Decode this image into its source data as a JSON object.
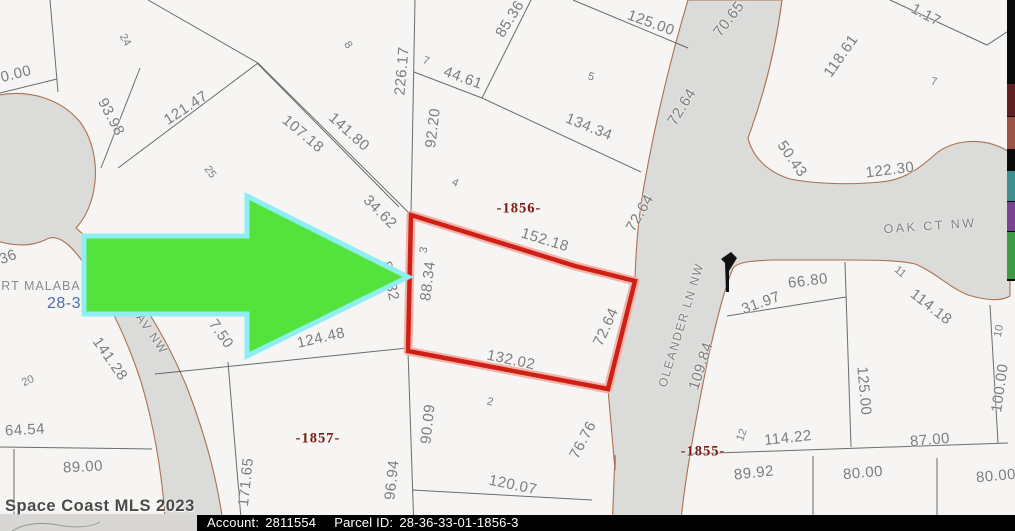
{
  "footer": {
    "watermark": "Space Coast MLS 2023",
    "account_label": "Account:",
    "account_value": "2811554",
    "parcel_label": "Parcel ID:",
    "parcel_value": "28-36-33-01-1856-3"
  },
  "colors": {
    "parcel_red": "#cf2016",
    "parcel_halo": "#f0b4ad",
    "arrow_green": "#54e33c",
    "arrow_cyan": "#8feef2",
    "road_gray": "#dbdbd9",
    "road_edge": "#ab7150",
    "line_gray": "#4a4a4a",
    "dim_gray": "#7d7d7d",
    "block_red": "#7a1a12",
    "plat_blue": "#4a6fae",
    "footer_bg": "#000000",
    "footer_text": "#ffffff"
  },
  "legend_strip": {
    "segments": [
      {
        "color": "#5e2020",
        "y": 84,
        "h": 32
      },
      {
        "color": "#9a5345",
        "y": 117,
        "h": 32
      },
      {
        "color": "#3d8e8c",
        "y": 171,
        "h": 30
      },
      {
        "color": "#7b4490",
        "y": 202,
        "h": 29
      },
      {
        "color": "#3e9a44",
        "y": 232,
        "h": 47
      }
    ]
  },
  "map": {
    "subject_parcel": {
      "block": "-1856-",
      "lot": "3",
      "dimensions": [
        "152.18",
        "72.64",
        "132.02",
        "88.34"
      ]
    },
    "labels": [
      {
        "t": "0.00",
        "x": 16,
        "y": 74,
        "r": -14,
        "c": "dim"
      },
      {
        "t": "93.98",
        "x": 111,
        "y": 117,
        "r": 62,
        "c": "dim"
      },
      {
        "t": "121.47",
        "x": 186,
        "y": 108,
        "r": -33,
        "c": "dim"
      },
      {
        "t": "107.18",
        "x": 303,
        "y": 134,
        "r": 40,
        "c": "dim"
      },
      {
        "t": "141.80",
        "x": 349,
        "y": 132,
        "r": 42,
        "c": "dim"
      },
      {
        "t": "226.17",
        "x": 402,
        "y": 71,
        "r": -85,
        "c": "dim"
      },
      {
        "t": "92.20",
        "x": 433,
        "y": 128,
        "r": -83,
        "c": "dim"
      },
      {
        "t": "44.61",
        "x": 463,
        "y": 78,
        "r": 20,
        "c": "dim"
      },
      {
        "t": "85.36",
        "x": 510,
        "y": 19,
        "r": -58,
        "c": "dim"
      },
      {
        "t": "125.00",
        "x": 651,
        "y": 23,
        "r": 20,
        "c": "dim"
      },
      {
        "t": "134.34",
        "x": 589,
        "y": 127,
        "r": 22,
        "c": "dim"
      },
      {
        "t": "70.65",
        "x": 729,
        "y": 19,
        "r": -52,
        "c": "dim"
      },
      {
        "t": "72.64",
        "x": 682,
        "y": 107,
        "r": -58,
        "c": "dim"
      },
      {
        "t": "118.61",
        "x": 841,
        "y": 56,
        "r": -55,
        "c": "dim"
      },
      {
        "t": "1.17",
        "x": 926,
        "y": 15,
        "r": 28,
        "c": "dim"
      },
      {
        "t": "122.30",
        "x": 890,
        "y": 170,
        "r": -7,
        "c": "dim"
      },
      {
        "t": "50.43",
        "x": 792,
        "y": 159,
        "r": 55,
        "c": "dim"
      },
      {
        "t": "72.64",
        "x": 640,
        "y": 213,
        "r": -60,
        "c": "dim"
      },
      {
        "t": "34.62",
        "x": 380,
        "y": 212,
        "r": 45,
        "c": "dim"
      },
      {
        "t": "152.18",
        "x": 545,
        "y": 240,
        "r": 17,
        "c": "dim"
      },
      {
        "t": "88.34",
        "x": 428,
        "y": 281,
        "r": -83,
        "c": "dim"
      },
      {
        "t": "88.32",
        "x": 390,
        "y": 281,
        "r": 78,
        "c": "dim"
      },
      {
        "t": "72.64",
        "x": 606,
        "y": 327,
        "r": -65,
        "c": "dim"
      },
      {
        "t": "132.02",
        "x": 511,
        "y": 360,
        "r": 12,
        "c": "dim"
      },
      {
        "t": "124.48",
        "x": 321,
        "y": 338,
        "r": -13,
        "c": "dim"
      },
      {
        "t": "7.50",
        "x": 221,
        "y": 334,
        "r": 55,
        "c": "dim"
      },
      {
        "t": "141.28",
        "x": 110,
        "y": 359,
        "r": 55,
        "c": "dim"
      },
      {
        "t": "66.80",
        "x": 808,
        "y": 281,
        "r": -7,
        "c": "dim"
      },
      {
        "t": "31.97",
        "x": 761,
        "y": 303,
        "r": -20,
        "c": "dim"
      },
      {
        "t": "114.18",
        "x": 931,
        "y": 307,
        "r": 38,
        "c": "dim"
      },
      {
        "t": "109.84",
        "x": 701,
        "y": 366,
        "r": -72,
        "c": "dim"
      },
      {
        "t": "125.00",
        "x": 864,
        "y": 391,
        "r": 85,
        "c": "dim"
      },
      {
        "t": "100.00",
        "x": 1000,
        "y": 388,
        "r": -82,
        "c": "dim"
      },
      {
        "t": "114.22",
        "x": 788,
        "y": 438,
        "r": -6,
        "c": "dim"
      },
      {
        "t": "87.00",
        "x": 930,
        "y": 440,
        "r": -5,
        "c": "dim"
      },
      {
        "t": "89.92",
        "x": 754,
        "y": 473,
        "r": -6,
        "c": "dim"
      },
      {
        "t": "80.00",
        "x": 863,
        "y": 473,
        "r": -5,
        "c": "dim"
      },
      {
        "t": "80.00",
        "x": 996,
        "y": 476,
        "r": -5,
        "c": "dim"
      },
      {
        "t": "76.76",
        "x": 583,
        "y": 440,
        "r": -62,
        "c": "dim"
      },
      {
        "t": "120.07",
        "x": 513,
        "y": 485,
        "r": 12,
        "c": "dim"
      },
      {
        "t": "90.09",
        "x": 428,
        "y": 424,
        "r": -84,
        "c": "dim"
      },
      {
        "t": "96.94",
        "x": 392,
        "y": 480,
        "r": -84,
        "c": "dim"
      },
      {
        "t": "171.65",
        "x": 246,
        "y": 482,
        "r": -84,
        "c": "dim"
      },
      {
        "t": "64.54",
        "x": 25,
        "y": 430,
        "r": -3,
        "c": "dim"
      },
      {
        "t": "89.00",
        "x": 83,
        "y": 467,
        "r": -3,
        "c": "dim"
      },
      {
        "t": "36",
        "x": 8,
        "y": 257,
        "r": -20,
        "c": "dim"
      },
      {
        "t": "24",
        "x": 125,
        "y": 40,
        "r": 60,
        "c": "lot"
      },
      {
        "t": "25",
        "x": 210,
        "y": 172,
        "r": 55,
        "c": "lot"
      },
      {
        "t": "8",
        "x": 348,
        "y": 45,
        "r": 55,
        "c": "lot"
      },
      {
        "t": "7",
        "x": 426,
        "y": 61,
        "r": 20,
        "c": "lot"
      },
      {
        "t": "4",
        "x": 455,
        "y": 183,
        "r": 25,
        "c": "lot"
      },
      {
        "t": "3",
        "x": 424,
        "y": 250,
        "r": -80,
        "c": "lot"
      },
      {
        "t": "5",
        "x": 591,
        "y": 77,
        "r": 15,
        "c": "lot"
      },
      {
        "t": "7",
        "x": 934,
        "y": 82,
        "r": 10,
        "c": "lot"
      },
      {
        "t": "2",
        "x": 490,
        "y": 402,
        "r": 15,
        "c": "lot"
      },
      {
        "t": "20",
        "x": 28,
        "y": 381,
        "r": -25,
        "c": "lot"
      },
      {
        "t": "11",
        "x": 900,
        "y": 272,
        "r": 40,
        "c": "lot"
      },
      {
        "t": "10",
        "x": 999,
        "y": 331,
        "r": -78,
        "c": "lot"
      },
      {
        "t": "12",
        "x": 742,
        "y": 435,
        "r": -70,
        "c": "lot"
      },
      {
        "t": "-1856-",
        "x": 519,
        "y": 209,
        "r": 0,
        "c": "block"
      },
      {
        "t": "-1857-",
        "x": 318,
        "y": 439,
        "r": 0,
        "c": "block"
      },
      {
        "t": "-1855-",
        "x": 703,
        "y": 452,
        "r": 0,
        "c": "block"
      },
      {
        "t": "OAK CT NW",
        "x": 930,
        "y": 226,
        "r": -4,
        "c": "street"
      },
      {
        "t": "OLEANDER LN NW",
        "x": 681,
        "y": 325,
        "r": -73,
        "c": "streetv"
      },
      {
        "t": "AV NW",
        "x": 152,
        "y": 334,
        "r": 55,
        "c": "streetv"
      },
      {
        "t": "PORT MALABAR",
        "x": 36,
        "y": 286,
        "r": 0,
        "c": "plat"
      },
      {
        "t": "28-3",
        "x": 64,
        "y": 304,
        "r": 0,
        "c": "platnum"
      }
    ]
  }
}
